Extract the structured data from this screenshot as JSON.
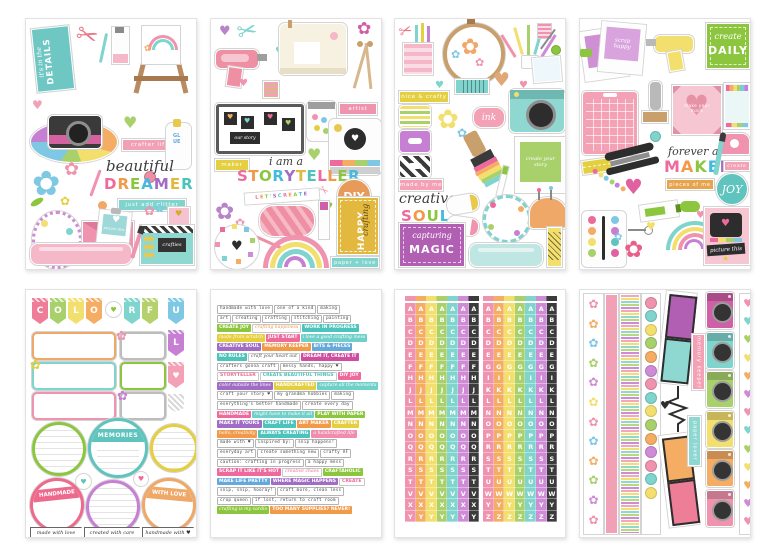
{
  "palette": [
    "#ee6a9c",
    "#f09a4a",
    "#8cc63e",
    "#45b9de",
    "#a06cc4",
    "#e3b83f",
    "#4cc3bb"
  ],
  "icons": {
    "heart": "♥",
    "flower": "✿",
    "scissors": "✂",
    "star": "★"
  },
  "sheets": {
    "s1": {
      "its_in_the": "it's in the",
      "details": "DETAILS",
      "crafter_life": "crafter life",
      "glue": "GLUE",
      "beautiful": "beautiful",
      "dreamer": "DREAMER",
      "just_add_glitter": "just add glitter",
      "picture_this": "picture this",
      "crafties": "crafties"
    },
    "s2": {
      "artist": "artist",
      "our_story": "our story",
      "maker": "maker",
      "i_am_a": "i am a",
      "storyteller": "STORYTELLER",
      "lets_create": "LET'S CREATE",
      "diy": "DIY",
      "happy": "HAPPY",
      "crafting": "crafting",
      "paper_love": "paper + love"
    },
    "s3": {
      "nice_crafty": "nice & crafty",
      "ink": "ink",
      "made_by_me": "made by me",
      "create_your_story": "create your story",
      "creative": "creative",
      "soul": "SOUL",
      "capturing": "capturing",
      "magic": "MAGIC"
    },
    "s4": {
      "scrap_happy": "scrap happy",
      "create_script": "create",
      "daily": "DAILY",
      "make_your_mark": "make your mark",
      "forever_a": "forever a",
      "maker": "MAKER",
      "create_label": "create",
      "pieces_of_me": "pieces of me",
      "joy": "JOY",
      "picture_this": "picture this"
    },
    "s5": {
      "pennant_letters": [
        "C",
        "O",
        "L",
        "O",
        "R",
        "F",
        "U",
        "L"
      ],
      "memories": "MEMORIES",
      "handmade": "HANDMADE",
      "with_love": "WITH LOVE",
      "made_with_love": "made with love",
      "created_with_care": "created with care",
      "handmade_with": "handmade with ♥"
    },
    "s6": {
      "rows": [
        [
          {
            "t": "handmade with love",
            "s": "tw"
          },
          {
            "t": "one of a kind",
            "s": "tw"
          },
          {
            "t": "making",
            "s": "tw"
          }
        ],
        [
          {
            "t": "art",
            "s": "tw"
          },
          {
            "t": "creating",
            "s": "tw"
          },
          {
            "t": "crafting",
            "s": "tw"
          },
          {
            "t": "stitching",
            "s": "tw"
          },
          {
            "t": "painting",
            "s": "tw"
          }
        ],
        [
          {
            "t": "CREATE JOY",
            "s": "green"
          },
          {
            "t": "crafting happiness",
            "s": "sc-o"
          },
          {
            "t": "WORK IN PROGRESS",
            "s": "teal"
          }
        ],
        [
          {
            "t": "made from scratch",
            "s": "y-s"
          },
          {
            "t": "JUST START",
            "s": "pink"
          },
          {
            "t": "i love a good crafting mess",
            "s": "t-s"
          }
        ],
        [
          {
            "t": "CREATIVE SOUL",
            "s": "purple"
          },
          {
            "t": "MEMORY KEEPER",
            "s": "orange"
          },
          {
            "t": "BITS & PIECES",
            "s": "blue"
          }
        ],
        [
          {
            "t": "NO RULES",
            "s": "teal"
          },
          {
            "t": "craft your heart out",
            "s": "sc-d"
          },
          {
            "t": "DREAM IT, CREATE IT",
            "s": "magenta"
          }
        ],
        [
          {
            "t": "crafters gonna craft",
            "s": "tw"
          },
          {
            "t": "messy hands, happy ♥",
            "s": "tw"
          }
        ],
        [
          {
            "t": "STORYTELLER",
            "s": "multi"
          },
          {
            "t": "CREATE BEAUTIFUL THINGS",
            "s": "multi2"
          },
          {
            "t": "DIY JOY",
            "s": "pink"
          }
        ],
        [
          {
            "t": "color outside the lines",
            "s": "p-s"
          },
          {
            "t": "HANDCRAFTED",
            "s": "yellow"
          },
          {
            "t": "capture all the moments",
            "s": "t-s"
          }
        ],
        [
          {
            "t": "craft your story ♥",
            "s": "tw"
          },
          {
            "t": "my grandma hobbies",
            "s": "tw"
          },
          {
            "t": "making",
            "s": "tw"
          }
        ],
        [
          {
            "t": "everything's better handmade",
            "s": "tw"
          },
          {
            "t": "create every day",
            "s": "tw"
          }
        ],
        [
          {
            "t": "HANDMADE",
            "s": "pink"
          },
          {
            "t": "might have to make it all",
            "s": "t-s"
          },
          {
            "t": "PLAY WITH PAPER",
            "s": "green"
          }
        ],
        [
          {
            "t": "MAKE IT YOURS",
            "s": "purple"
          },
          {
            "t": "CRAFT LIFE",
            "s": "teal"
          },
          {
            "t": "ART MAKER",
            "s": "orange"
          },
          {
            "t": "CRAFTER",
            "s": "yellow"
          }
        ],
        [
          {
            "t": "hello, creativity",
            "s": "o-s"
          },
          {
            "t": "ALWAYS CREATING",
            "s": "teal"
          },
          {
            "t": "a handcrafted life",
            "s": "pk-s"
          }
        ],
        [
          {
            "t": "made with ♥",
            "s": "tw"
          },
          {
            "t": "inspired by:",
            "s": "tw"
          },
          {
            "t": "snip happens!",
            "s": "tw"
          }
        ],
        [
          {
            "t": "everyday art",
            "s": "tw"
          },
          {
            "t": "create something new",
            "s": "tw"
          },
          {
            "t": "crafty AF",
            "s": "tw"
          }
        ],
        [
          {
            "t": "caution: crafting in progress",
            "s": "tw"
          },
          {
            "t": "a happy mess",
            "s": "tw"
          }
        ],
        [
          {
            "t": "SCRAP IT LIKE IT'S HOT",
            "s": "pink"
          },
          {
            "t": "creative chaos",
            "s": "sc-p"
          },
          {
            "t": "CRAFTAHOLIC",
            "s": "green"
          }
        ],
        [
          {
            "t": "MAKE LIFE PRETTY",
            "s": "blue"
          },
          {
            "t": "WHERE MAGIC HAPPENS",
            "s": "purple"
          },
          {
            "t": "CREATE",
            "s": "multi"
          }
        ],
        [
          {
            "t": "snip, snip, hooray!",
            "s": "tw"
          },
          {
            "t": "craft more, clean less",
            "s": "tw"
          }
        ],
        [
          {
            "t": "crop queen",
            "s": "tw"
          },
          {
            "t": "if lost, return to craft room",
            "s": "tw"
          }
        ],
        [
          {
            "t": "crafting is my cardio",
            "s": "g-s"
          },
          {
            "t": "TOO MANY SUPPLIES? NEVER!",
            "s": "orange"
          }
        ]
      ]
    },
    "s7": {
      "left_letters": [
        "A",
        "B",
        "C",
        "D",
        "E",
        "F",
        "H",
        "J",
        "L",
        "M",
        "N",
        "O",
        "Q",
        "R",
        "S",
        "T",
        "V",
        "X",
        "Y"
      ],
      "right_letters": [
        "A",
        "B",
        "C",
        "D",
        "E",
        "G",
        "I",
        "K",
        "L",
        "N",
        "O",
        "P",
        "R",
        "S",
        "T",
        "U",
        "W",
        "Y",
        "Z"
      ],
      "column_colors": [
        "#f093ae",
        "#f5ad64",
        "#f2df6d",
        "#a8d16c",
        "#7fd4cd",
        "#d08bd6",
        "#3b3b3b"
      ]
    },
    "s8": {
      "memory_keeper": "memory keeper",
      "paper_lover": "paper lover",
      "camera_colors": [
        "#cf5fa6",
        "#7fd4cd",
        "#a8d16c",
        "#f2df6d",
        "#f5ad64",
        "#f093ae"
      ],
      "heart_colors": [
        "#f093ae",
        "#7fd4cd",
        "#a8d16c",
        "#f2df6d",
        "#f5ad64",
        "#d08bd6",
        "#f093ae",
        "#7fd4cd",
        "#a8d16c",
        "#f2df6d",
        "#f5ad64",
        "#d08bd6",
        "#f093ae"
      ],
      "button_colors": [
        "#f093ae",
        "#7fd4cd",
        "#f2df6d",
        "#a8d16c",
        "#f5ad64",
        "#d08bd6",
        "#f093ae",
        "#7fd4cd",
        "#f2df6d",
        "#a8d16c",
        "#f5ad64",
        "#d08bd6",
        "#f093ae",
        "#7fd4cd",
        "#f2df6d"
      ],
      "floral_colors": [
        "#f093ae",
        "#f5ad64",
        "#7ec8e3",
        "#a8d16c",
        "#d08bd6",
        "#f2df6d",
        "#f093ae",
        "#7ec8e3",
        "#f5ad64",
        "#a8d16c",
        "#d08bd6",
        "#f093ae"
      ]
    }
  }
}
